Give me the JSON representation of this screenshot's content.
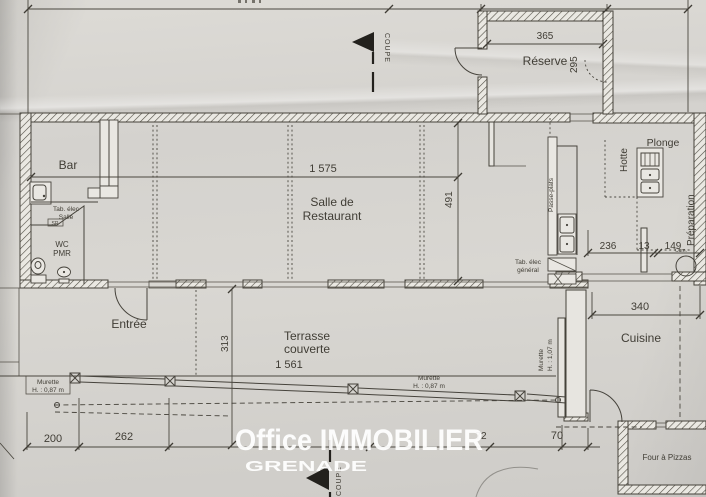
{
  "watermark": {
    "line1": "Office IMMOBILIER",
    "line2": "GRENADE"
  },
  "rooms": {
    "bar": "Bar",
    "salle_1": "Salle de",
    "salle_2": "Restaurant",
    "reserve": "Réserve",
    "entree": "Entrée",
    "terrasse_1": "Terrasse",
    "terrasse_2": "couverte",
    "cuisine": "Cuisine",
    "plonge": "Plonge",
    "hotte": "Hotte",
    "preparation": "Préparation",
    "passe_plats": "Passe-plats",
    "wc_1": "WC",
    "wc_2": "PMR",
    "four_pizzas": "Four à Pizzas"
  },
  "labels": {
    "tab_salle_1": "Tab. élec",
    "tab_salle_2": "Salle",
    "sr": "SR",
    "tab_general_1": "Tab. élec",
    "tab_general_2": "général",
    "cum": "Cum.",
    "murette_087_1": "Murette",
    "murette_087_2": "H. : 0,87 m",
    "murette_107_1": "Murette",
    "murette_107_2": "H. : 1,07 m",
    "coupe": "COUPE"
  },
  "dims": {
    "salle_w": "1 575",
    "salle_d": "491",
    "reserve_w": "365",
    "reserve_d": "295",
    "prep_a": "236",
    "prep_b": "13",
    "prep_c": "149",
    "cuisine_w": "340",
    "terrasse_w": "1 561",
    "terrasse_d": "313",
    "b1": "200",
    "b2": "262",
    "b3": "72",
    "b4": "70"
  }
}
